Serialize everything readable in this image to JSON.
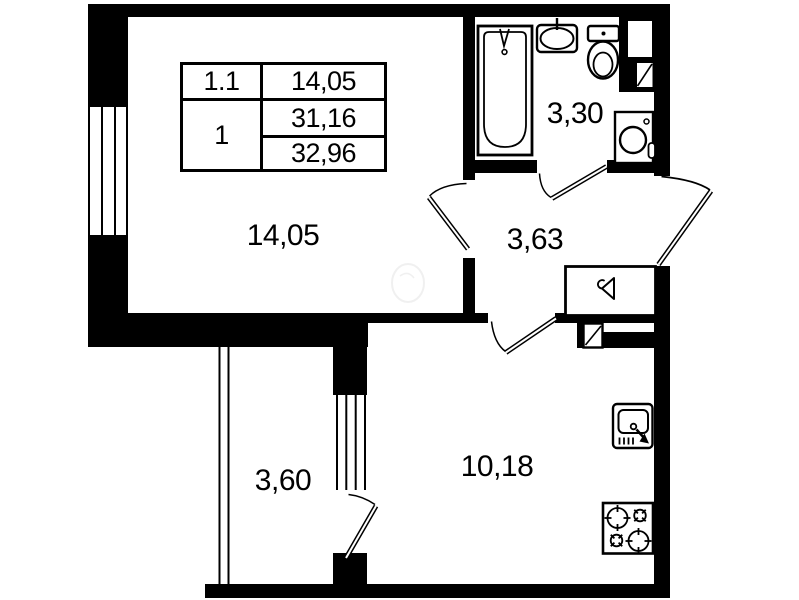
{
  "plan": {
    "type": "apartment-floor-plan",
    "colors": {
      "wall": "#000000",
      "background": "#ffffff",
      "fixture_line": "#000000"
    },
    "info_table": {
      "apartment_number": "1.1",
      "room_count": "1",
      "living_area": "14,05",
      "area_without_balcony": "31,16",
      "total_area": "32,96"
    },
    "rooms": {
      "living": {
        "area": "14,05"
      },
      "bathroom": {
        "area": "3,30"
      },
      "hallway": {
        "area": "3,63"
      },
      "balcony": {
        "area": "3,60"
      },
      "kitchen": {
        "area": "10,18"
      }
    },
    "fixture_icons": [
      "bathtub-icon",
      "washbasin-icon",
      "toilet-icon",
      "washing-machine-icon",
      "vent-shaft-icon",
      "wardrobe-hanger-icon",
      "kitchen-sink-icon",
      "stove-icon",
      "window-icon",
      "door-swing-icon"
    ]
  }
}
